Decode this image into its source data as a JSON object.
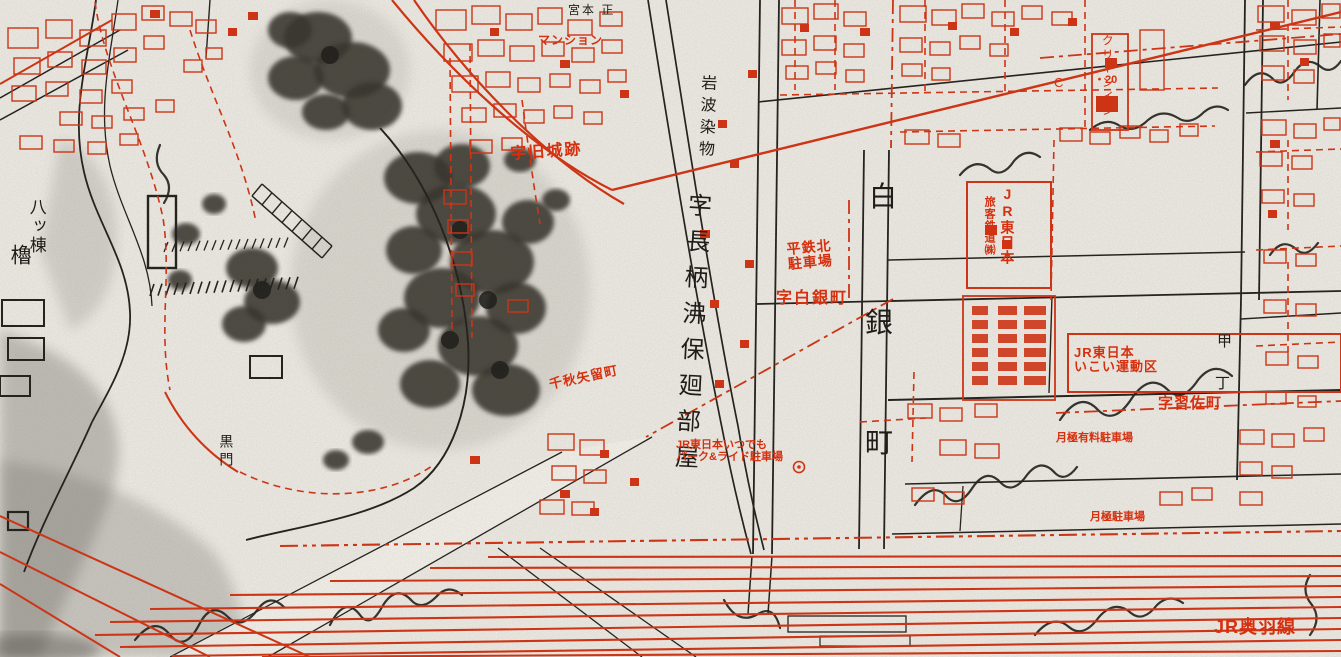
{
  "meta": {
    "kind": "scanned Japanese cadastral city-planning map (Akita, Senshu-park / station area)",
    "palette": {
      "paper": "#f1eee7",
      "red_ink": "#d6300f",
      "black_ink": "#1f1d19",
      "pencil_gray": "#7d7b75"
    }
  },
  "labels": [
    {
      "id": "yatsumune-yagura-upper",
      "text": "八ッ棟",
      "x": 26,
      "y": 198,
      "size": 17,
      "color": "black",
      "dir": "v",
      "ls": 2,
      "bold": false,
      "rot": 0
    },
    {
      "id": "yatsumune-yagura-lower",
      "text": "櫓",
      "x": 8,
      "y": 244,
      "size": 21,
      "color": "black",
      "dir": "v",
      "ls": 0,
      "bold": false,
      "rot": 0
    },
    {
      "id": "aza-kyujoseki",
      "text": "字旧城跡",
      "x": 510,
      "y": 146,
      "size": 16,
      "color": "red",
      "dir": "h",
      "ls": 2,
      "bold": true,
      "rot": -4
    },
    {
      "id": "iwanami-somemono",
      "text": "岩波染物",
      "x": 698,
      "y": 74,
      "size": 16,
      "color": "black",
      "dir": "v",
      "ls": 6,
      "bold": false,
      "rot": 2
    },
    {
      "id": "aza-nagae-heya",
      "text": "字長柄沸保廻部屋",
      "x": 684,
      "y": 192,
      "size": 24,
      "color": "black",
      "dir": "v",
      "ls": 12,
      "bold": false,
      "rot": 3
    },
    {
      "id": "heitetsu-kita-parking",
      "text": "平鉄北\n駐車場",
      "x": 786,
      "y": 242,
      "size": 14,
      "color": "red",
      "dir": "h",
      "ls": 1,
      "bold": true,
      "rot": -5
    },
    {
      "id": "aza-shiroganemachi",
      "text": "字白銀町",
      "x": 776,
      "y": 290,
      "size": 16,
      "color": "red",
      "dir": "h",
      "ls": 2,
      "bold": true,
      "rot": 0
    },
    {
      "id": "shiroganemachi-1",
      "text": "白",
      "x": 869,
      "y": 182,
      "size": 28,
      "color": "black",
      "dir": "h",
      "ls": 0,
      "bold": false,
      "rot": 0
    },
    {
      "id": "shiroganemachi-2",
      "text": "銀",
      "x": 865,
      "y": 308,
      "size": 28,
      "color": "black",
      "dir": "h",
      "ls": 0,
      "bold": false,
      "rot": 0
    },
    {
      "id": "shiroganemachi-3",
      "text": "町",
      "x": 865,
      "y": 428,
      "size": 28,
      "color": "black",
      "dir": "h",
      "ls": 0,
      "bold": false,
      "rot": 0
    },
    {
      "id": "jr-east-japan-vert",
      "text": "JR東日本",
      "x": 999,
      "y": 186,
      "size": 14,
      "color": "red",
      "dir": "v",
      "ls": 1,
      "bold": true,
      "rot": 0
    },
    {
      "id": "jr-ryokaku-tetsudo",
      "text": "旅客鉄道㈱",
      "x": 983,
      "y": 196,
      "size": 11,
      "color": "red",
      "dir": "v",
      "ls": 1,
      "bold": true,
      "rot": 0
    },
    {
      "id": "jr-east-undoku",
      "text": "JR東日本\nいこい運動区",
      "x": 1074,
      "y": 346,
      "size": 13,
      "color": "red",
      "dir": "h",
      "ls": 1,
      "bold": true,
      "rot": 0
    },
    {
      "id": "aza-narisa-machi",
      "text": "字習佐町",
      "x": 1158,
      "y": 396,
      "size": 15,
      "color": "red",
      "dir": "h",
      "ls": 1,
      "bold": true,
      "rot": 0
    },
    {
      "id": "tsukigime-yuryo-parking",
      "text": "月極有料駐車場",
      "x": 1056,
      "y": 432,
      "size": 11,
      "color": "red",
      "dir": "h",
      "ls": 0,
      "bold": true,
      "rot": 0
    },
    {
      "id": "tsukigime-parking",
      "text": "月極駐車場",
      "x": 1090,
      "y": 511,
      "size": 11,
      "color": "red",
      "dir": "h",
      "ls": 0,
      "bold": true,
      "rot": 0
    },
    {
      "id": "jr-park-and-ride",
      "text": "JR東日本いつでも\nパーク&ライド駐車場",
      "x": 676,
      "y": 439,
      "size": 11,
      "color": "red",
      "dir": "h",
      "ls": 0,
      "bold": true,
      "rot": 0
    },
    {
      "id": "jr-ouu-line",
      "text": "JR奥羽線",
      "x": 1214,
      "y": 618,
      "size": 18,
      "color": "red",
      "dir": "h",
      "ls": 1,
      "bold": true,
      "rot": 0
    },
    {
      "id": "chiaki-yadomecho",
      "text": "千秋矢留町",
      "x": 548,
      "y": 378,
      "size": 13,
      "color": "red",
      "dir": "h",
      "ls": 1,
      "bold": true,
      "rot": -12
    },
    {
      "id": "clean-inn",
      "text": "クリーンイン",
      "x": 1100,
      "y": 34,
      "size": 12,
      "color": "red",
      "dir": "v",
      "ls": 2,
      "bold": false,
      "rot": 0
    },
    {
      "id": "marker-20",
      "text": "・20",
      "x": 1094,
      "y": 74,
      "size": 11,
      "color": "red",
      "dir": "h",
      "ls": 0,
      "bold": true,
      "rot": 0
    },
    {
      "id": "letter-c",
      "text": "C",
      "x": 1054,
      "y": 76,
      "size": 13,
      "color": "red",
      "dir": "h",
      "ls": 0,
      "bold": false,
      "rot": 0
    },
    {
      "id": "kuromon-gate",
      "text": "黒門",
      "x": 218,
      "y": 434,
      "size": 14,
      "color": "black",
      "dir": "v",
      "ls": 4,
      "bold": false,
      "rot": 0
    },
    {
      "id": "mansion",
      "text": "マンション",
      "x": 538,
      "y": 34,
      "size": 12,
      "color": "red",
      "dir": "h",
      "ls": 1,
      "bold": true,
      "rot": 0
    },
    {
      "id": "miyamoto-tadashi",
      "text": "宮本 正",
      "x": 568,
      "y": 4,
      "size": 12,
      "color": "black",
      "dir": "h",
      "ls": 2,
      "bold": false,
      "rot": 0
    },
    {
      "id": "kou-char",
      "text": "甲",
      "x": 1217,
      "y": 334,
      "size": 15,
      "color": "black",
      "dir": "h",
      "ls": 0,
      "bold": false,
      "rot": 0
    },
    {
      "id": "cho-char",
      "text": "丁",
      "x": 1215,
      "y": 376,
      "size": 15,
      "color": "black",
      "dir": "h",
      "ls": 0,
      "bold": false,
      "rot": 0
    }
  ]
}
